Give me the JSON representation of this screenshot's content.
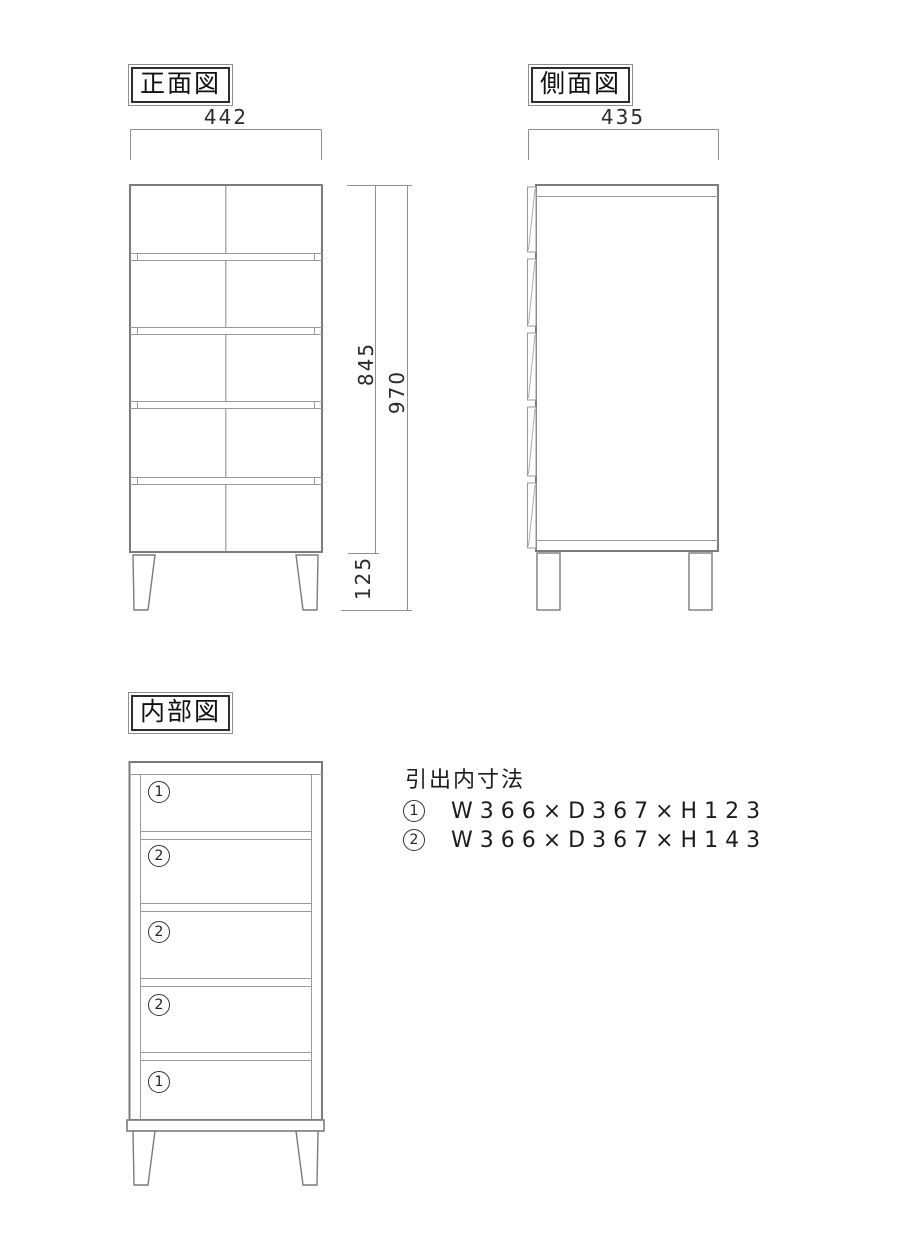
{
  "views": {
    "front": {
      "label": "正面図"
    },
    "side": {
      "label": "側面図"
    },
    "internal": {
      "label": "内部図",
      "compartments": [
        "1",
        "2",
        "2",
        "2",
        "1"
      ]
    }
  },
  "dimensions": {
    "front_width": "442",
    "side_depth": "435",
    "body_height": "845",
    "total_height": "970",
    "leg_height": "125"
  },
  "spec": {
    "title": "引出内寸法",
    "rows": [
      {
        "num": "1",
        "label": "W366×D367×H123"
      },
      {
        "num": "2",
        "label": "W366×D367×H143"
      }
    ]
  },
  "colors": {
    "outline": "#7b7b7b",
    "inner_line": "#9a9a9a",
    "center_line": "#aeaeae",
    "dim_line": "#8f8f8f",
    "text": "#1c1c1c",
    "background": "#ffffff"
  }
}
